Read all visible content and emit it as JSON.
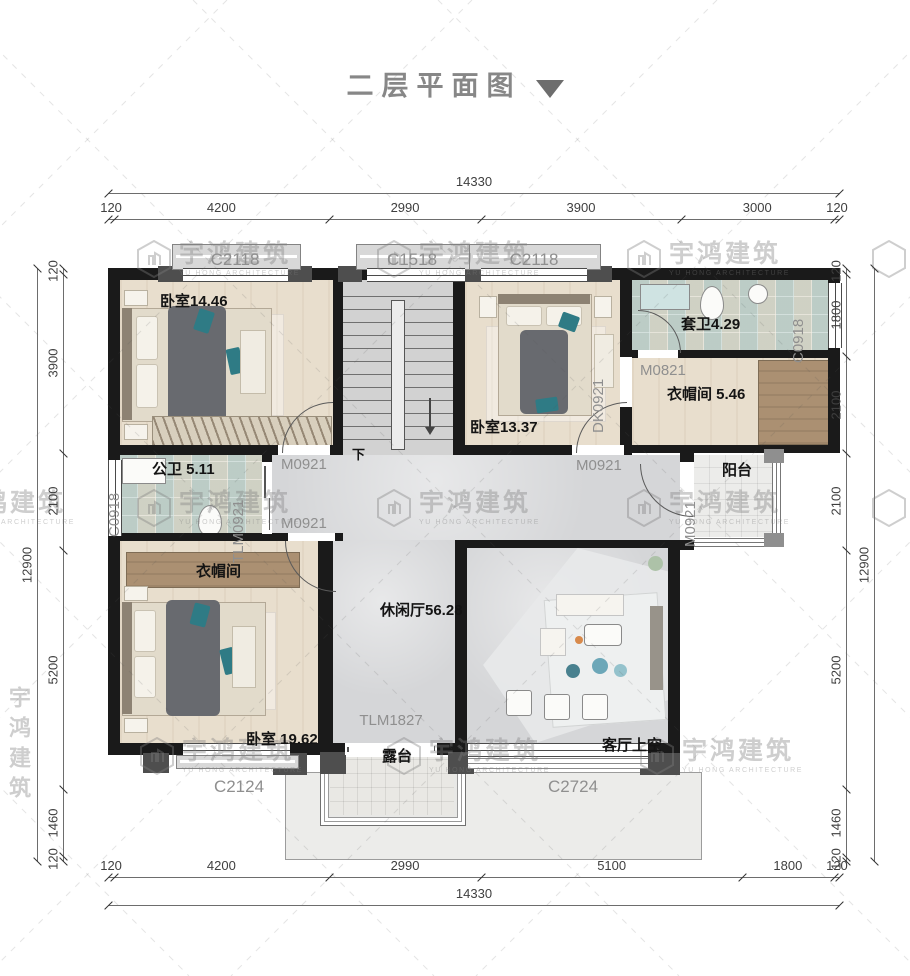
{
  "title": {
    "text": "二层平面图",
    "caret": "dropdown-triangle"
  },
  "watermark": {
    "cjk": "宇鸿建筑",
    "latin": "YU HONG ARCHITECTURE"
  },
  "labels": {
    "bedroom1": "卧室14.46",
    "bedroom2": "卧室13.37",
    "bedroom3": "卧室 19.62",
    "ensuite_bath": "套卫4.29",
    "closet_upper": "衣帽间 5.46",
    "public_bath": "公卫 5.11",
    "closet_lower": "衣帽间",
    "leisure_hall": "休闲厅56.28",
    "living_void": "客厅上空",
    "terrace": "露台",
    "balcony": "阳台",
    "stairs_down": "下"
  },
  "openings": {
    "c2118_left": "C2118",
    "c1518": "C1518",
    "c2118_mid": "C2118",
    "c0918_right": "C0918",
    "c0918_left": "C0918",
    "c2124": "C2124",
    "c2724": "C2724",
    "tlm1827": "TLM1827",
    "tlm0921": "TLM0921",
    "dk0921": "DK0921",
    "m0821": "M0821",
    "m0921_bed1": "M0921",
    "m0921_closet": "M0921",
    "m0921_bed2": "M0921",
    "m0921_balcony": "M0921"
  },
  "dimensions": {
    "top": {
      "total": "14330",
      "segments": [
        "120",
        "4200",
        "2990",
        "3900",
        "3000",
        "120"
      ]
    },
    "bottom": {
      "total": "14330",
      "segments": [
        "120",
        "4200",
        "2990",
        "5100",
        "1800",
        "120"
      ]
    },
    "left": {
      "total": "12900",
      "segments": [
        "120",
        "3900",
        "2100",
        "5200",
        "1460",
        "120"
      ]
    },
    "right": {
      "total": "12900",
      "segments": [
        "120",
        "1800",
        "2100",
        "2100",
        "5200",
        "1460",
        "120"
      ]
    }
  },
  "colors": {
    "wall": "#1a1a1a",
    "wood_floor": "#e8decd",
    "dark_wood": "#ab9072",
    "marble": "#d5d6d8",
    "bath_tile": "#ccd5cf",
    "teal_accent": "#2f7b85",
    "open_label": "#8f8f8f",
    "dim_text": "#3f3f3f",
    "watermark": "#c9c9c9",
    "title_gray": "#878787"
  }
}
